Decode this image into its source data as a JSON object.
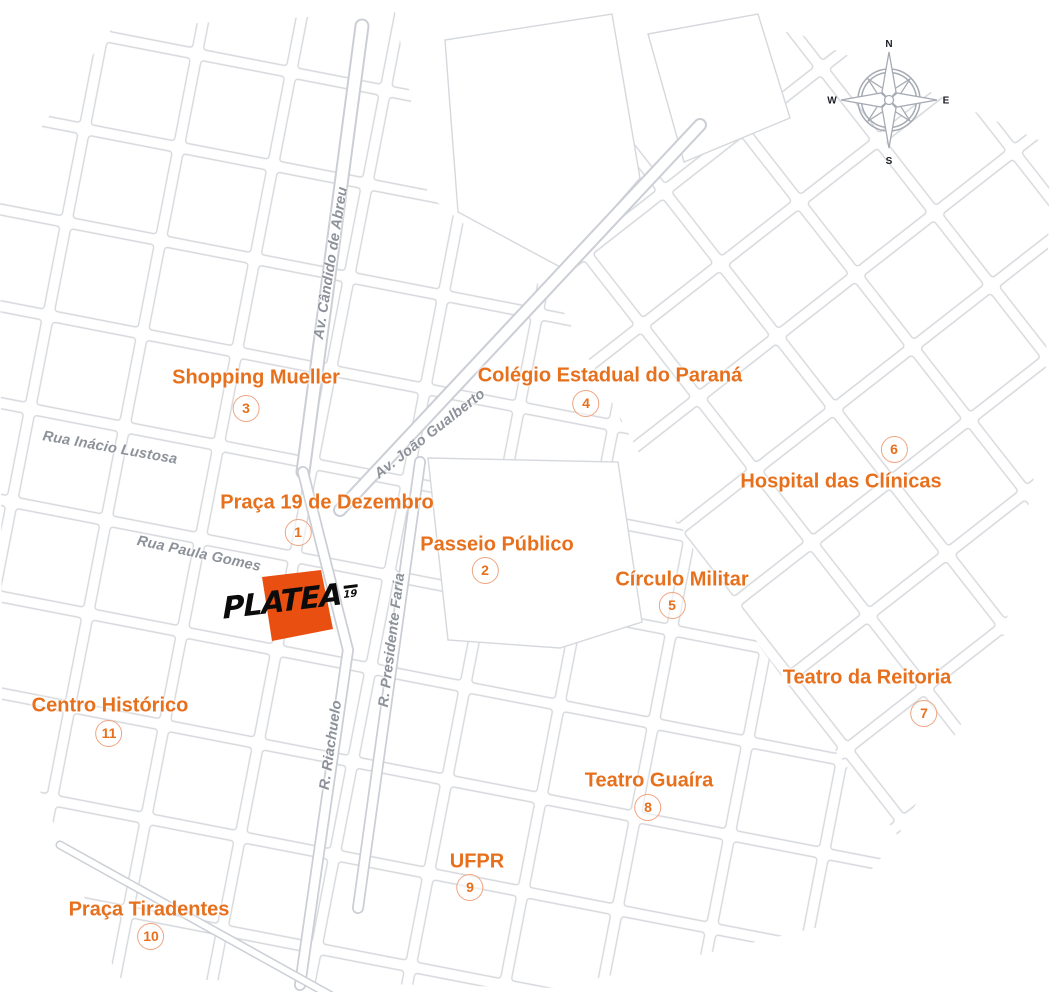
{
  "map": {
    "type": "static-location-map",
    "colors": {
      "accent": "#E7701D",
      "badge_border": "#EFA480",
      "marker": "#E84F10",
      "street_line": "#D5D8DC",
      "street_label": "#8C919A",
      "background": "#FFFFFF"
    },
    "brand": {
      "logo_text": "PLATEA",
      "logo_superscript": "19"
    },
    "compass": {
      "north": "N",
      "south": "S",
      "east": "E",
      "west": "W"
    },
    "streets": [
      {
        "name": "Av. Cândido de Abreu"
      },
      {
        "name": "Rua Inácio Lustosa"
      },
      {
        "name": "Av. João Gualberto"
      },
      {
        "name": "Rua Paula Gomes"
      },
      {
        "name": "R. Presidente Faria"
      },
      {
        "name": "R. Riachuelo"
      }
    ],
    "pois": [
      {
        "number": "1",
        "label": "Praça 19 de Dezembro"
      },
      {
        "number": "2",
        "label": "Passeio Público"
      },
      {
        "number": "3",
        "label": "Shopping Mueller"
      },
      {
        "number": "4",
        "label": "Colégio Estadual do Paraná"
      },
      {
        "number": "5",
        "label": "Círculo Militar"
      },
      {
        "number": "6",
        "label": "Hospital das Clínicas"
      },
      {
        "number": "7",
        "label": "Teatro da Reitoria"
      },
      {
        "number": "8",
        "label": "Teatro Guaíra"
      },
      {
        "number": "9",
        "label": "UFPR"
      },
      {
        "number": "10",
        "label": "Praça Tiradentes"
      },
      {
        "number": "11",
        "label": "Centro Histórico"
      }
    ]
  }
}
